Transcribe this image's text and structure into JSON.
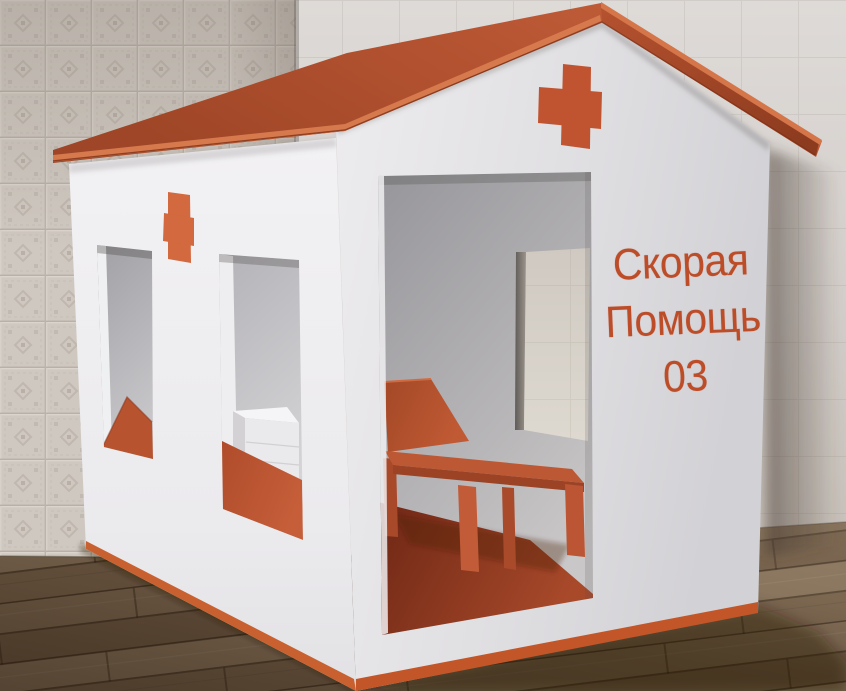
{
  "scene": {
    "type": "3d-render",
    "subject": "toy ambulance playhouse in a room corner"
  },
  "sign": {
    "line1": "Скорая",
    "line2": "Помощь",
    "line3": "03"
  },
  "colors": {
    "roof_orange": "#b45331",
    "wall_white": "#e9e8ea",
    "cross_orange": "#c15430",
    "sign_text": "#bc4d28",
    "base_trim": "#c25628",
    "interior_floor": "#8d3a22",
    "furniture_orange": "#bd5733",
    "wood_floor": "#74604a",
    "tiled_wall": "#cfc8c0",
    "plain_wall": "#d5d1ce"
  }
}
